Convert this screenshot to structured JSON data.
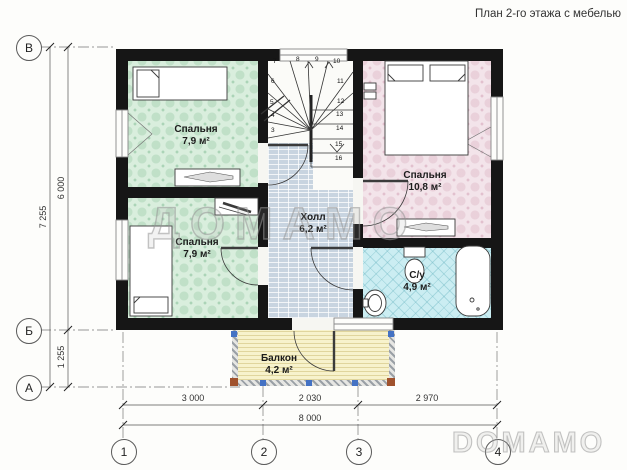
{
  "title": "План 2-го этажа с мебелью",
  "watermarks": {
    "center": "ДОМАМО",
    "corner": "DOMAMO"
  },
  "axes": {
    "rows": [
      {
        "label": "В"
      },
      {
        "label": "Б"
      },
      {
        "label": "А"
      }
    ],
    "cols": [
      {
        "label": "1"
      },
      {
        "label": "2"
      },
      {
        "label": "3"
      },
      {
        "label": "4"
      }
    ]
  },
  "dimensions": {
    "left_total": "7 255",
    "left_upper": "6 000",
    "left_lower": "1 255",
    "bottom_segments": [
      "3 000",
      "2 030",
      "2 970"
    ],
    "bottom_total": "8 000"
  },
  "rooms": {
    "bedroom_top_left": {
      "name": "Спальня",
      "area": "7,9 м²"
    },
    "bedroom_bottom_left": {
      "name": "Спальня",
      "area": "7,9 м²"
    },
    "bedroom_right": {
      "name": "Спальня",
      "area": "10,8 м²"
    },
    "hall": {
      "name": "Холл",
      "area": "6,2 м²"
    },
    "bathroom": {
      "name": "С/у",
      "area": "4,9 м²"
    },
    "balcony": {
      "name": "Балкон",
      "area": "4,2 м²"
    }
  },
  "stairs": {
    "steps": [
      "3",
      "4",
      "5",
      "6",
      "7",
      "8",
      "9",
      "10",
      "11",
      "12",
      "13",
      "14",
      "15",
      "16"
    ]
  },
  "colors": {
    "wall": "#161616",
    "bedroom_green": "#d9eedd",
    "bedroom_pink": "#f3e4ea",
    "hall_blue": "#c8d4e0",
    "bath_cyan": "#cbedf2",
    "balcony_yellow": "#f7f2cc",
    "post_blue": "#4472c4",
    "post_brown": "#a0522d"
  }
}
